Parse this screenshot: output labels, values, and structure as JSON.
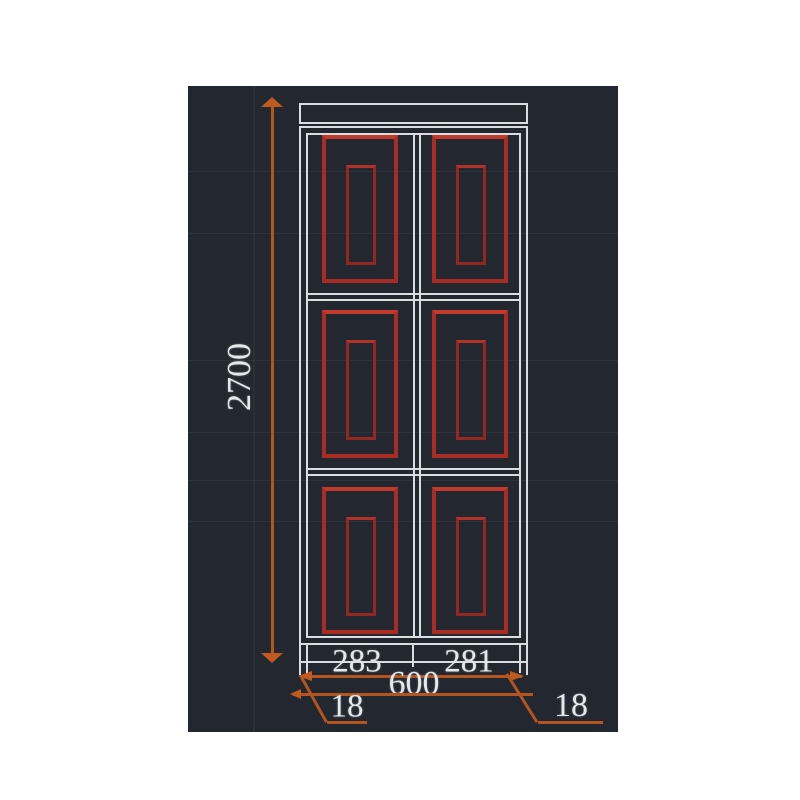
{
  "drawing": {
    "type": "cad-door-elevation",
    "description": "Dark CAD viewport showing a double-leaf door elevation with six red raised panels and orange/white dimension annotations",
    "dimensions": {
      "overall_height": "2700",
      "leaf_left_width": "283",
      "leaf_right_width": "281",
      "overall_width": "600",
      "frame_left_thickness": "18",
      "frame_right_thickness": "18"
    },
    "door": {
      "leaves": 2,
      "panels_per_leaf": 3,
      "panel_style": "nested rectangular mouldings"
    },
    "colors": {
      "viewport_background": "#232830",
      "frame_lines": "#d9dce0",
      "panel_mouldings": "#a82b24",
      "dimension_lines": "#b4541e",
      "dimension_text": "#e5e8eb",
      "page_background": "#ffffff"
    }
  }
}
